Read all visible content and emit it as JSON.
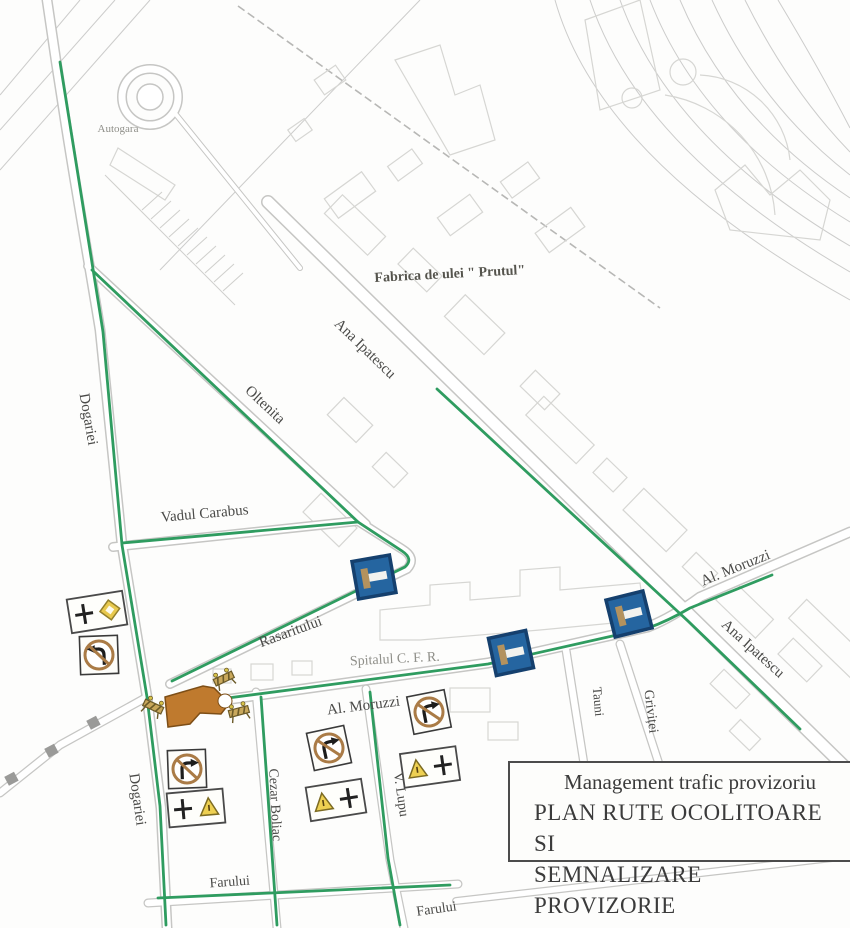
{
  "title_box": {
    "line1": "Management trafic provizoriu",
    "line2": "PLAN RUTE OCOLITOARE SI",
    "line3": "SEMNALIZARE PROVIZORIE"
  },
  "street_labels": {
    "autogara": "Autogara",
    "fabrica": "Fabrica de ulei \" Prutul\"",
    "ana_ipatescu": "Ana Ipatescu",
    "dogariei": "Dogariei",
    "oltenita": "Oltenita",
    "vadul_carabus": "Vadul Carabus",
    "rasaritului": "Rasaritului",
    "spitalul_cfr": "Spitalul  C. F. R.",
    "al_moruzzi": "Al. Moruzzi",
    "tauni": "Tauni",
    "grivitei": "Griviței",
    "cezar_boliac": "Cezar Boliac",
    "v_lupu": "V. Lupu",
    "farului": "Farului"
  },
  "signs": [
    {
      "id": "P1",
      "type": "priority-intersection-panel",
      "variant": "cross-and-diamond",
      "street": "Dogariei"
    },
    {
      "id": "N1",
      "type": "no-left-turn-sign",
      "street": "Dogariei"
    },
    {
      "id": "B1",
      "type": "dead-end-street-sign",
      "street": "Rasaritului"
    },
    {
      "id": "B2",
      "type": "dead-end-street-sign",
      "street": "Al. Moruzzi"
    },
    {
      "id": "B3",
      "type": "dead-end-street-sign",
      "street": "Al. Moruzzi / Ana Ipatescu"
    },
    {
      "id": "N2",
      "type": "no-right-turn-sign",
      "street": "Dogariei"
    },
    {
      "id": "P2",
      "type": "priority-intersection-panel",
      "variant": "cross-and-triangle",
      "street": "Dogariei"
    },
    {
      "id": "N3",
      "type": "no-right-turn-sign",
      "street": "Al. Moruzzi / Cezar Boliac"
    },
    {
      "id": "P3",
      "type": "priority-intersection-panel",
      "variant": "triangle-and-cross",
      "street": "Cezar Boliac"
    },
    {
      "id": "N4",
      "type": "no-right-turn-sign",
      "street": "V. Lupu"
    },
    {
      "id": "P4",
      "type": "priority-intersection-panel",
      "variant": "triangle-and-cross",
      "street": "V. Lupu"
    }
  ],
  "work_zone": {
    "type": "road-closure",
    "barriers": 3,
    "location": "Dogariei / Rasaritului / Al. Moruzzi fork"
  },
  "colors": {
    "route_green": "#2f9c60",
    "street_casing": "#c6c6c4",
    "building_outline": "#d6d6d3",
    "closure_orange": "#bf7a2e",
    "sign_blue": "#2565a0",
    "sign_ring_brown": "#aa7b46",
    "priority_yellow": "#e8c94e"
  }
}
